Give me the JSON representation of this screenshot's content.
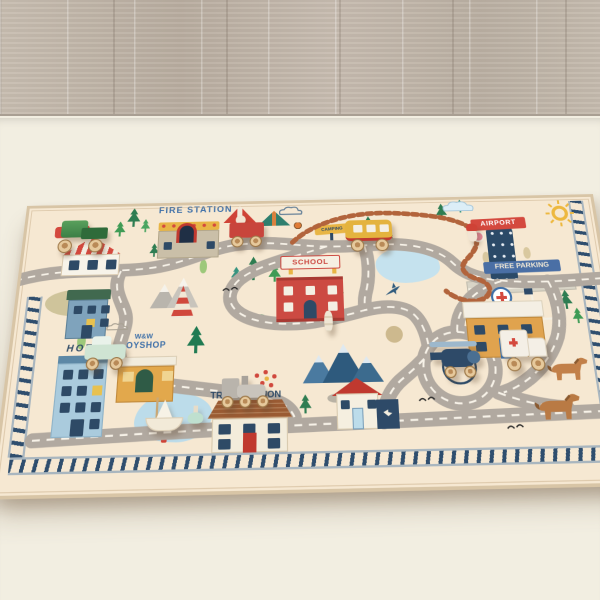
{
  "rug": {
    "labels": {
      "fire_station": "FIRE STATION",
      "fuel": "FUEL",
      "camping": "CAMPING",
      "school": "SCHOOL",
      "airport": "AIRPORT",
      "free_parking": "FREE PARKING",
      "hotel": "HOTEL",
      "toyshop_line1": "W&W",
      "toyshop_line2": "TOYSHOP",
      "train_station": "TRAIN STATION",
      "speed_limit_sign": "30"
    },
    "colors": {
      "rug_base": "#f6e8d2",
      "rug_trim": "#d8c5a6",
      "road": "#b1a9a0",
      "road_centerline": "#f7f2e8",
      "dirt_path": "#b2643c",
      "railway": "#2f4e6e",
      "sign_red": "#d4493e",
      "sign_blue": "#4a6fa5",
      "label_blue": "#3d6fa8",
      "school_red": "#cc4a42",
      "hotel_blue": "#aacbdd",
      "shop_orange": "#e2a84c",
      "tree_green": "#3e9b55",
      "floor_wood": "#c2b7ab",
      "floor_mat": "#f2eee1"
    },
    "icons": {
      "sun-icon": "sun",
      "cloud-icon": "cloud",
      "pine-tree-icon": "pine tree",
      "cypress-tree-icon": "cypress tree",
      "mountain-icon": "mountains",
      "pond-icon": "pond",
      "airplane-icon": "airplane",
      "bird-icon": "birds",
      "horse-icon": "horse",
      "red-cross-icon": "hospital cross",
      "tent-icon": "tent",
      "campfire-icon": "campfire",
      "flower-icon": "flowers",
      "parking-grid-icon": "parking spaces",
      "runway-icon": "airport runway",
      "roundabout-icon": "roundabout",
      "railway-icon": "railway track border"
    },
    "toys": [
      "green wooden car",
      "red wooden wagon",
      "yellow wooden bus",
      "wooden peg figure",
      "red striped cone",
      "mint wooden car",
      "white sailboat",
      "mint spinning top",
      "gray wooden train",
      "navy wooden helicopter",
      "white ambulance"
    ]
  }
}
